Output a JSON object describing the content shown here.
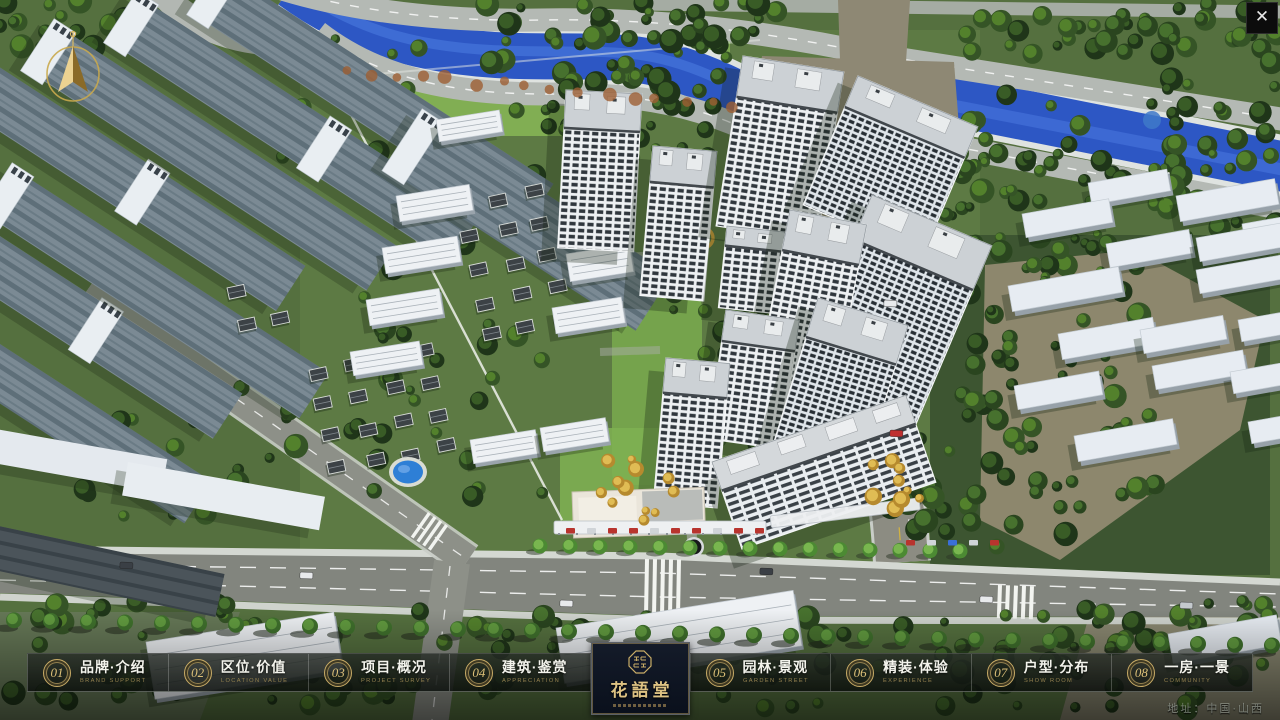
{
  "window": {
    "close_glyph": "✕"
  },
  "menu": {
    "items": [
      {
        "num": "01",
        "label": "品牌·介绍",
        "sub": "BRAND SUPPORT"
      },
      {
        "num": "02",
        "label": "区位·价值",
        "sub": "LOCATION VALUE"
      },
      {
        "num": "03",
        "label": "项目·概况",
        "sub": "PROJECT SURVEY"
      },
      {
        "num": "04",
        "label": "建筑·鉴赏",
        "sub": "APPRECIATION"
      },
      {
        "num": "05",
        "label": "园林·景观",
        "sub": "GARDEN STREET"
      },
      {
        "num": "06",
        "label": "精装·体验",
        "sub": "EXPERIENCE"
      },
      {
        "num": "07",
        "label": "户型·分布",
        "sub": "SHOW ROOM"
      },
      {
        "num": "08",
        "label": "一房·一景",
        "sub": "COMMUNITY"
      }
    ]
  },
  "logo": {
    "title": "花語堂"
  },
  "footer": {
    "address": "地址：中国·山西"
  },
  "palette": {
    "gold": "#c8ab66",
    "gold_dim": "#93804f",
    "river": "#2d57c4",
    "grass": "#6a9647",
    "road": "#83867f",
    "tree_dark": "#24381d"
  }
}
